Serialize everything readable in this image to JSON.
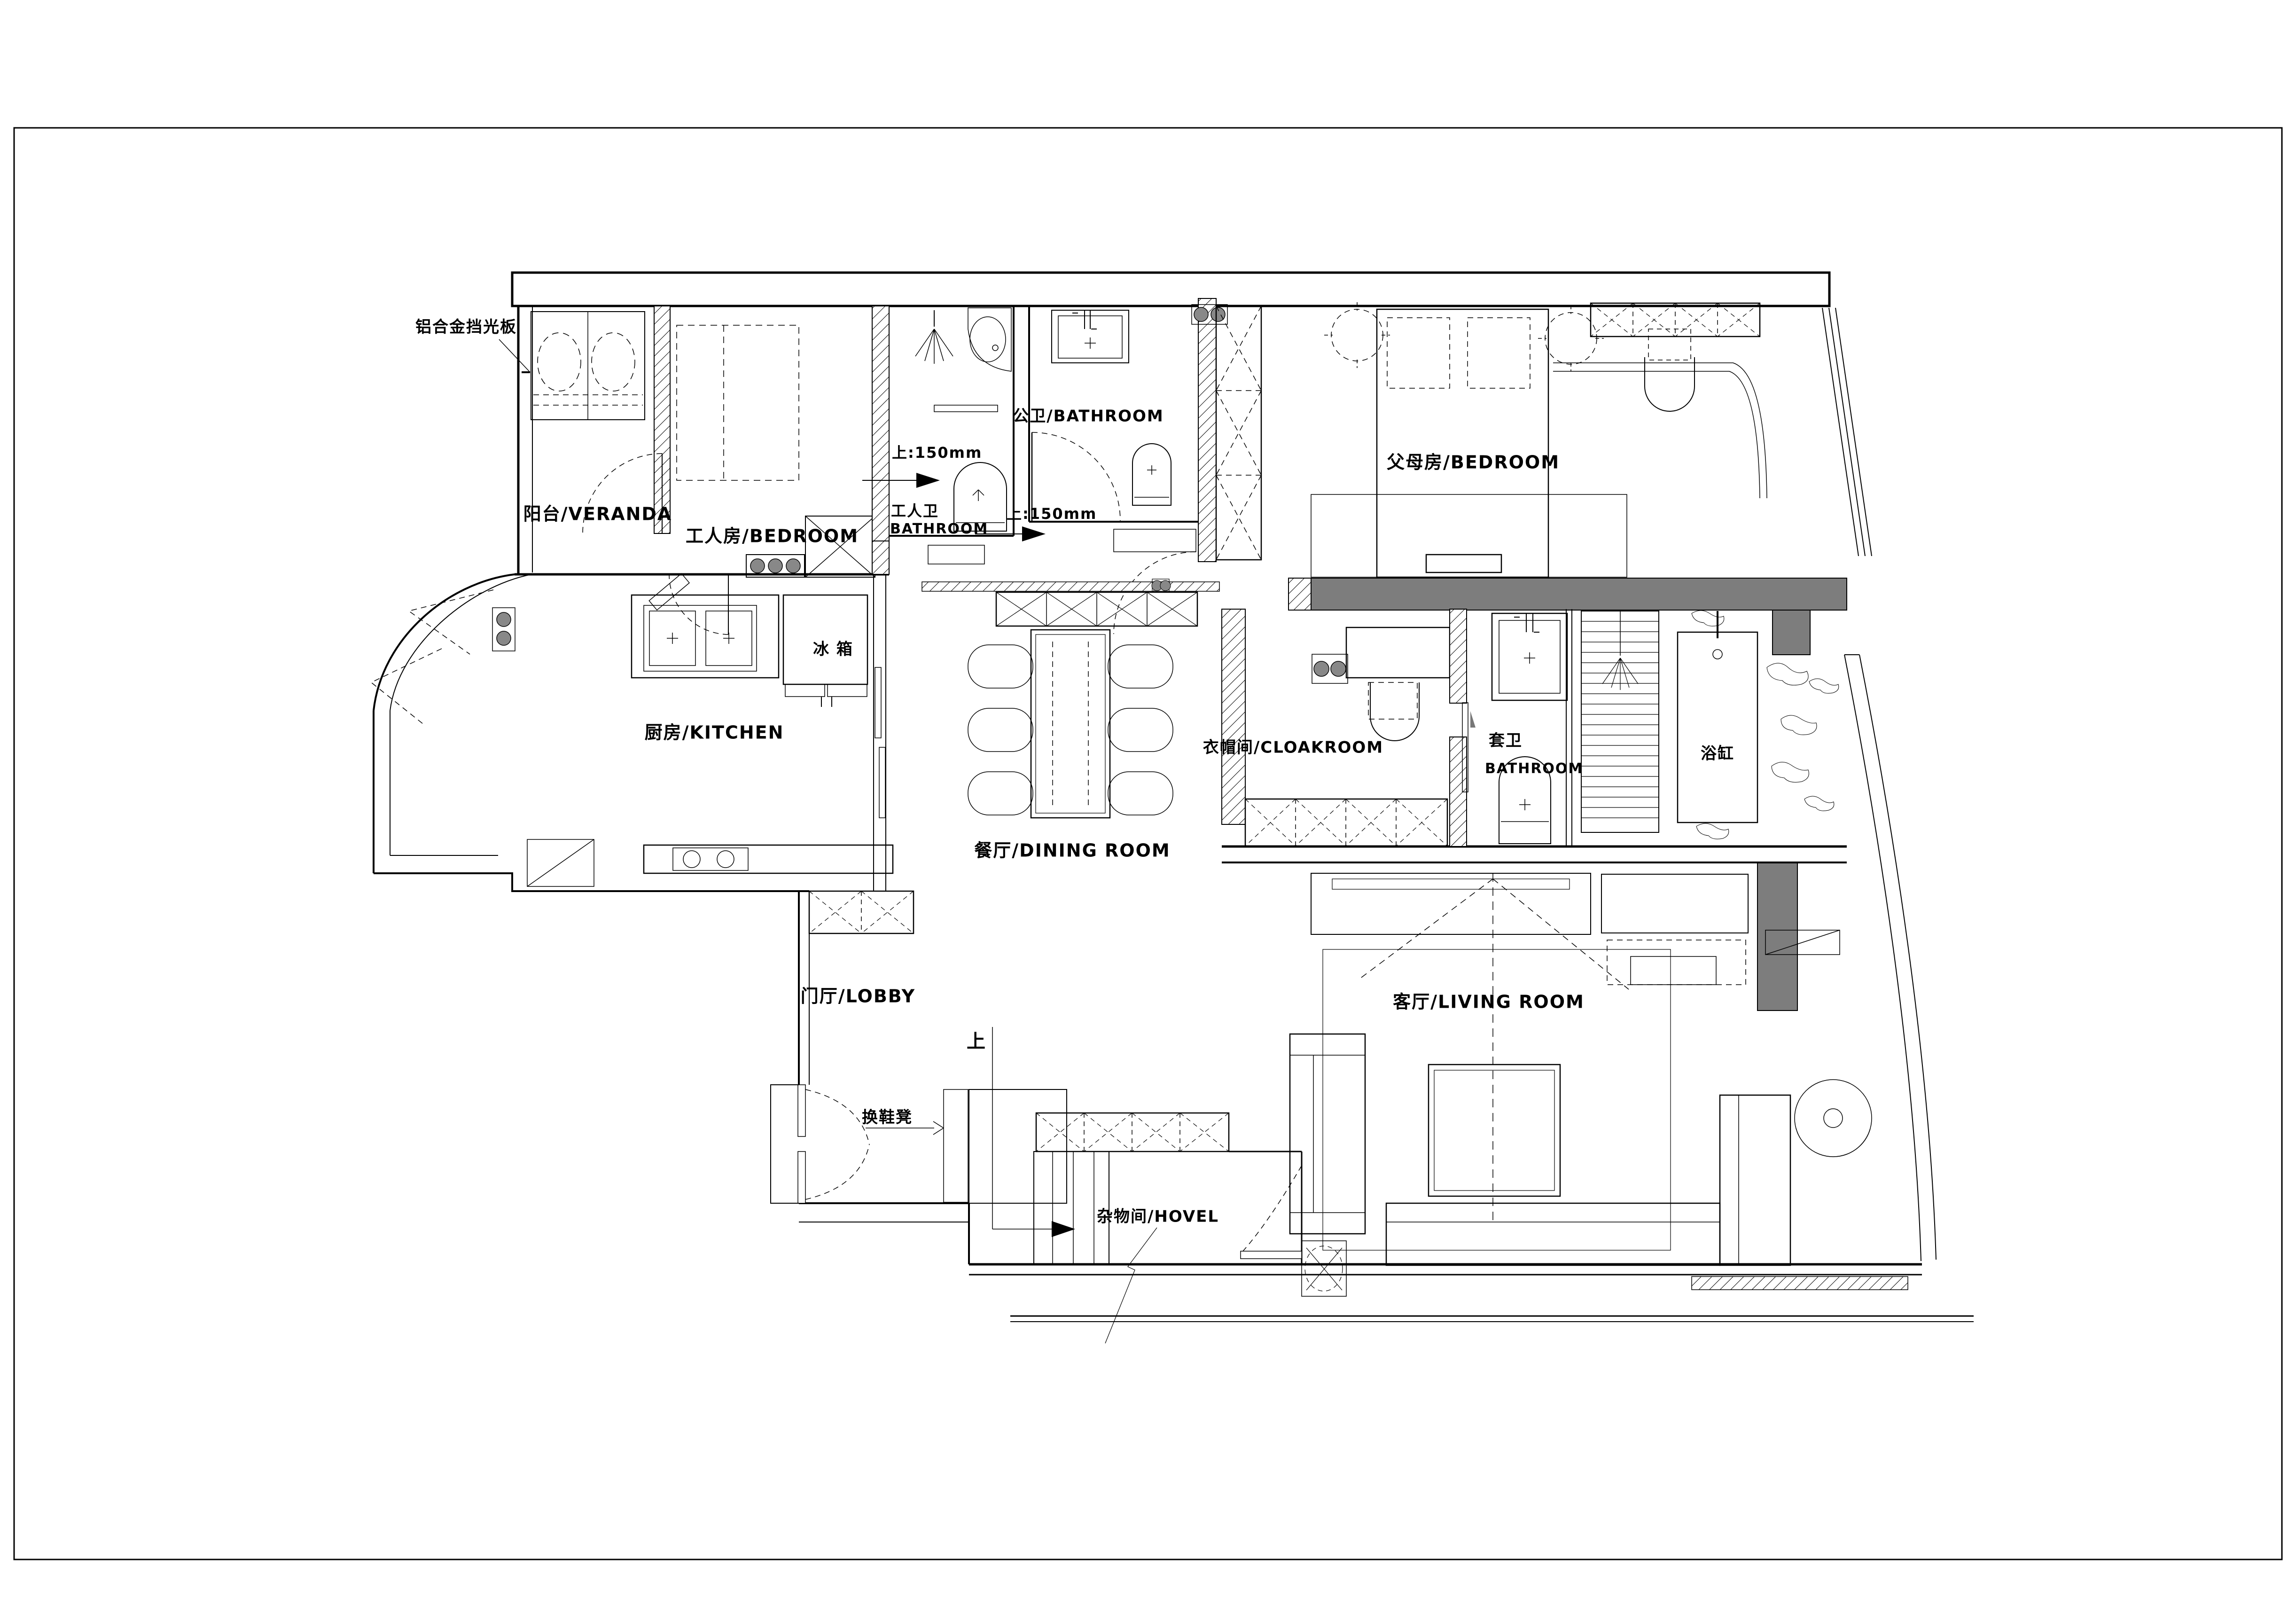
{
  "drawing": {
    "type": "apartment-floor-plan",
    "background": "#ffffff",
    "line_color": "#000000",
    "wall_fill_gray": "#7d7d7d",
    "hatch_style": "diagonal-45"
  },
  "labels": {
    "sunshade": "铝合金挡光板",
    "veranda": "阳台/VERANDA",
    "worker_bedroom": "工人房/BEDROOM",
    "worker_bath_cn": "工人卫",
    "worker_bath_en": "BATHROOM",
    "step_up_150_a": "上:150mm",
    "step_up_150_b": "上:150mm",
    "public_bath": "公卫/BATHROOM",
    "parents_bedroom": "父母房/BEDROOM",
    "fridge": "冰 箱",
    "kitchen": "厨房/KITCHEN",
    "cloakroom": "衣帽间/CLOAKROOM",
    "suite_bath_cn": "套卫",
    "suite_bath_en": "BATHROOM",
    "bathtub": "浴缸",
    "dining": "餐厅/DINING ROOM",
    "living": "客厅/LIVING ROOM",
    "lobby": "门厅/LOBBY",
    "stairs_up": "上",
    "shoe_bench": "换鞋凳",
    "hovel": "杂物间/HOVEL"
  }
}
